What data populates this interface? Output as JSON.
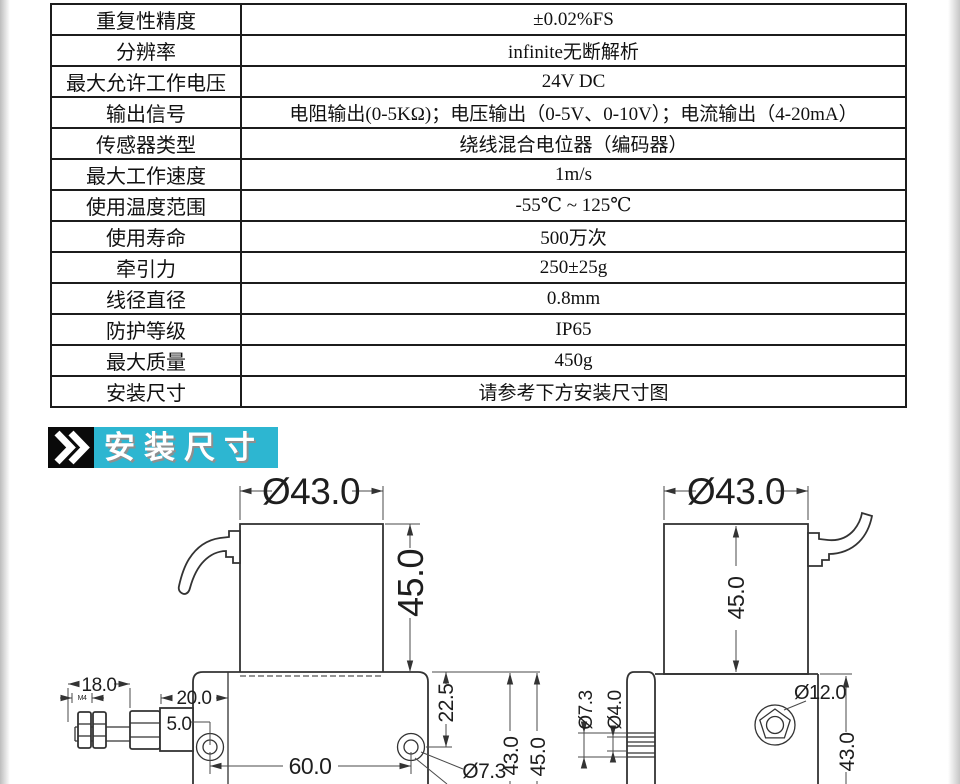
{
  "table": {
    "rows": [
      {
        "label": "重复性精度",
        "value": "±0.02%FS"
      },
      {
        "label": "分辨率",
        "value": "infinite无断解析"
      },
      {
        "label": "最大允许工作电压",
        "value": "24V DC"
      },
      {
        "label": "输出信号",
        "value": "电阻输出(0-5KΩ)；电压输出（0-5V、0-10V）；电流输出（4-20mA）"
      },
      {
        "label": "传感器类型",
        "value": "绕线混合电位器（编码器）"
      },
      {
        "label": "最大工作速度",
        "value": "1m/s"
      },
      {
        "label": "使用温度范围",
        "value": "-55℃ ~ 125℃"
      },
      {
        "label": "使用寿命",
        "value": "500万次"
      },
      {
        "label": "牵引力",
        "value": "250±25g"
      },
      {
        "label": "线径直径",
        "value": "0.8mm"
      },
      {
        "label": "防护等级",
        "value": "IP65"
      },
      {
        "label": "最大质量",
        "value": "450g"
      },
      {
        "label": "安装尺寸",
        "value": "请参考下方安装尺寸图"
      }
    ]
  },
  "banner": {
    "title": "安装尺寸",
    "bg_color": "#2db6d1",
    "text_color": "#ffffff"
  },
  "drawings": {
    "left": {
      "dia_top": "Ø43.0",
      "body_height": "45.0",
      "thread_length": "18.0",
      "thread_spec": "M4",
      "block_length": "20.0",
      "hole_edge_offset": "5.0",
      "hole_pitch": "60.0",
      "hole_diameter": "Ø7.3",
      "hole_top_offset": "22.5",
      "base_dim_43": "43.0",
      "base_dim_45": "45.0"
    },
    "right": {
      "dia_top": "Ø43.0",
      "body_height": "45.0",
      "guide_outer_dia": "Ø7.3",
      "guide_groove_dia": "Ø4.0",
      "outlet_dia": "Ø12.0",
      "base_dim_43": "43.0"
    }
  }
}
